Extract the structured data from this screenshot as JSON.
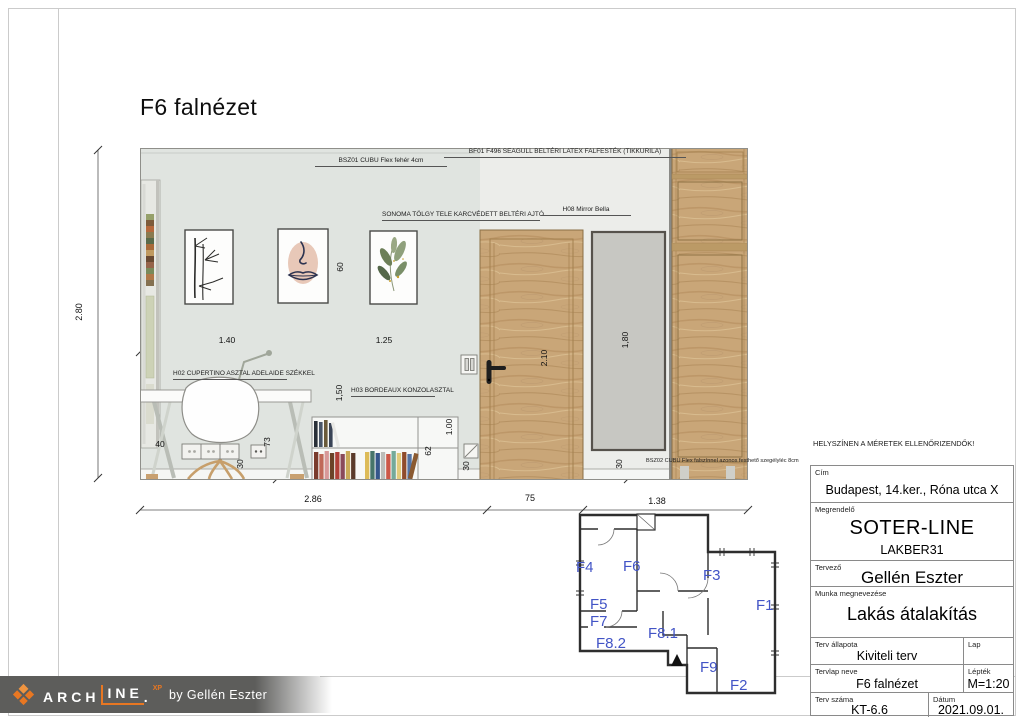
{
  "colors": {
    "wall_left": "#e0e4e0",
    "wall_right": "#ecedea",
    "wood": "#c9a678",
    "mirror_gray": "#c7c7c2",
    "plan_label_blue": "#4254c6",
    "logo_orange": "#e87722",
    "logo_bar_gray": "#5d5d5b"
  },
  "page": {
    "title": "F6 falnézet"
  },
  "annotations": {
    "bsz01": "BSZ01 CUBU Flex fehér 4cm",
    "bf01": "BF01 F496 SEAGULL BELTÉRI LATEX FALFESTÉK (TIKKURILA)",
    "door": "SONOMA TÖLGY TELE KARCVÉDETT BELTÉRI AJTÓ",
    "mirror": "H08 Mirror Bella",
    "desk": "H02 CUPERTINO ASZTAL ADELAIDE SZÉKKEL",
    "console": "H03 BORDEAUX KONZOLASZTAL",
    "bsz02": "BSZ02 CUBU Flex falszínnel azonos festhető szegélyléc 8cm"
  },
  "dimensions": {
    "wall_height": "2.80",
    "left_span": "1.40",
    "right_span": "1.25",
    "picture_gap": "60",
    "door_height": "2.10",
    "mirror_height": "1,80",
    "mirror_floor": "30",
    "desk_depth": "40",
    "desk_height": "73",
    "socket_height": "30",
    "console_span": "1,50",
    "console_right": "1.00",
    "console_height": "62",
    "console_floor": "30",
    "bottom_left": "2.86",
    "bottom_door": "75",
    "bottom_right": "1.38"
  },
  "floorplan": {
    "labels": [
      "F4",
      "F6",
      "F3",
      "F5",
      "F7",
      "F8.2",
      "F8.1",
      "F1",
      "F9",
      "F2"
    ]
  },
  "titleblock": {
    "warning": "HELYSZÍNEN A MÉRETEK ELLENŐRIZENDŐK!",
    "cim_label": "Cím",
    "cim_value": "Budapest, 14.ker., Róna utca X",
    "megrendelo_label": "Megrendelő",
    "megrendelo_value": "SOTER-LINE",
    "megrendelo_value2": "LAKBER31",
    "tervezo_label": "Tervező",
    "tervezo_value": "Gellén Eszter",
    "munka_label": "Munka megnevezése",
    "munka_value": "Lakás átalakítás",
    "allapot_label": "Terv állapota",
    "allapot_value": "Kiviteli terv",
    "lap_label": "Lap",
    "lap_value": "",
    "tervlap_label": "Tervlap neve",
    "tervlap_value": "F6 falnézet",
    "leptek_label": "Lépték",
    "leptek_value": "M=1:20",
    "szam_label": "Terv száma",
    "szam_value": "KT-6.6",
    "datum_label": "Dátum",
    "datum_value": "2021.09.01."
  },
  "logo": {
    "arch": "ARCH",
    "ine": "INE",
    "dot": ".",
    "xp": "XP",
    "byline": "by Gellén Eszter"
  }
}
